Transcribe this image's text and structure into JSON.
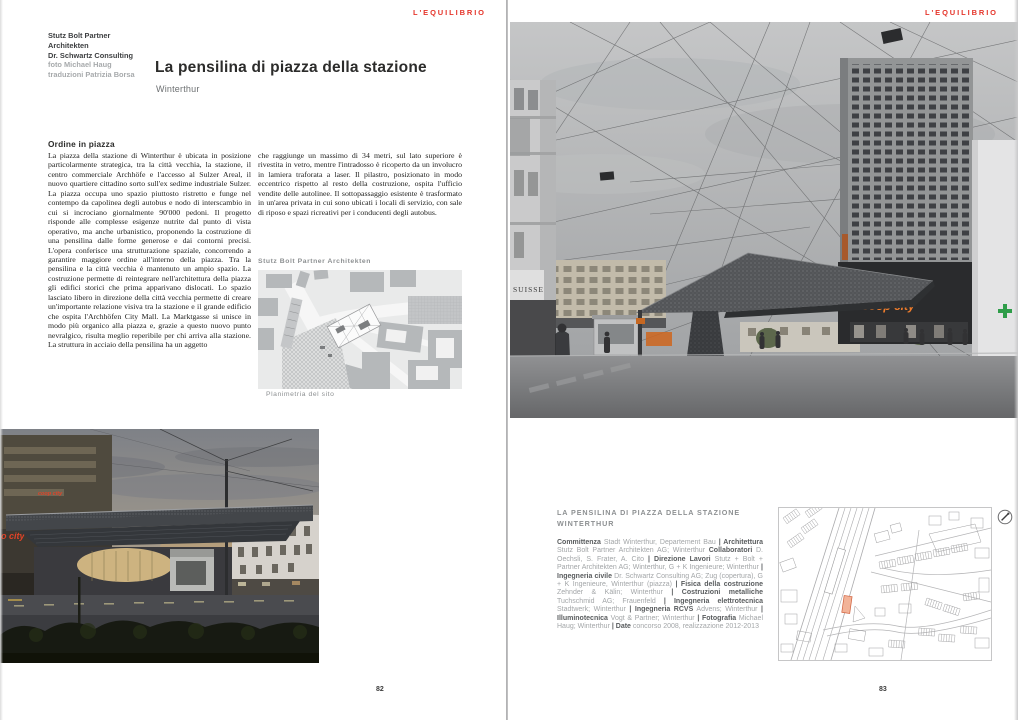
{
  "magazine": {
    "name": "L'EQUILIBRIO",
    "accent_color": "#e5352b"
  },
  "left_page": {
    "page_number": "82",
    "byline": {
      "bold_lines": [
        "Stutz Bolt Partner",
        "Architekten",
        "Dr. Schwartz Consulting"
      ],
      "light_lines": [
        "foto Michael Haug",
        "traduzioni Patrizia Borsa"
      ]
    },
    "title": "La pensilina di piazza della stazione",
    "subtitle": "Winterthur",
    "section_heading": "Ordine in piazza",
    "body_col1": "La piazza della stazione di Winterthur è ubicata in posizione particolarmente strategica, tra la città vecchia, la stazione, il centro commerciale Archhöfe e l'accesso al Sulzer Areal, il nuovo quartiere cittadino sorto sull'ex sedime industriale Sulzer. La piazza occupa uno spazio piuttosto ristretto e funge nel contempo da capolinea degli autobus e nodo di interscambio in cui si incrociano giornalmente 90'000 pedoni. Il progetto risponde alle complesse esigenze nutrite dal punto di vista operativo, ma anche urbanistico, proponendo la costruzione di una pensilina dalle forme generose e dai contorni precisi. L'opera conferisce una strutturazione spaziale, concorrendo a garantire maggiore ordine all'interno della piazza. Tra la pensilina e la città vecchia è mantenuto un ampio spazio. La costruzione permette di reintegrare nell'architettura della piazza gli edifici storici che prima apparivano dislocati. Lo spazio lasciato libero in direzione della città vecchia permette di creare un'importante relazione visiva tra la stazione e il grande edificio che ospita l'Archhöfen City Mall. La Marktgasse si unisce in modo più organico alla piazza e, grazie a questo nuovo punto nevralgico, risulta meglio reperibile per chi arriva alla stazione. La struttura in acciaio della pensilina ha un aggetto",
    "body_col2": "che raggiunge un massimo di 34 metri, sul lato superiore è rivestita in vetro, mentre l'intradosso è ricoperto da un involucro in lamiera traforata a laser. Il pilastro, posizionato in modo eccentrico rispetto al resto della costruzione, ospita l'ufficio vendite delle autolinee. Il sottopassaggio esistente è trasformato in un'area privata in cui sono ubicati i locali di servizio, con sale di riposo e spazi ricreativi per i conducenti degli autobus.",
    "plan_credit": "Stutz Bolt Partner Architekten",
    "plan_caption": "Planimetria del sito"
  },
  "right_page": {
    "page_number": "83",
    "project": {
      "title_line1": "LA PENSILINA DI PIAZZA DELLA STAZIONE",
      "title_line2": "WINTERTHUR",
      "credits": [
        {
          "label": "Committenza",
          "text": " Stadt Winterthur, Departement Bau "
        },
        {
          "label": "| Architettura",
          "text": " Stutz Bolt Partner Architekten AG; Winterthur "
        },
        {
          "label": "Collaboratori",
          "text": " D. Oechsli, S. Frater, A. Cito "
        },
        {
          "label": "| Direzione Lavori",
          "text": " Stutz + Bolt + Partner Architekten AG; Winterthur, G + K Ingenieure; Winterthur "
        },
        {
          "label": "| Ingegneria civile",
          "text": " Dr. Schwartz Consulting AG; Zug (copertura), G + K Ingenieure, Winterthur (piazza) "
        },
        {
          "label": "| Fisica della costruzione",
          "text": " Zehnder & Kälin; Winterthur "
        },
        {
          "label": "| Costruzioni metalliche",
          "text": " Tuchschmid AG; Frauenfeld "
        },
        {
          "label": "| Ingegneria elettrotecnica",
          "text": " Stadtwerk; Winterthur "
        },
        {
          "label": "| Ingegneria RCVS",
          "text": " Advens; Winterthur "
        },
        {
          "label": "| Illuminotecnica",
          "text": " Vogt & Partner; Winterthur "
        },
        {
          "label": "| Fotografia",
          "text": " Michael Haug; Winterthur "
        },
        {
          "label": "| Date",
          "text": " concorso 2008, realizzazione 2012-2013"
        }
      ]
    }
  },
  "photo_labels": {
    "suisse_sign": "SUISSE",
    "coop_city_right": "coop city",
    "coop_city_left_top": "coop city",
    "coop_city_left_side": "o city"
  }
}
